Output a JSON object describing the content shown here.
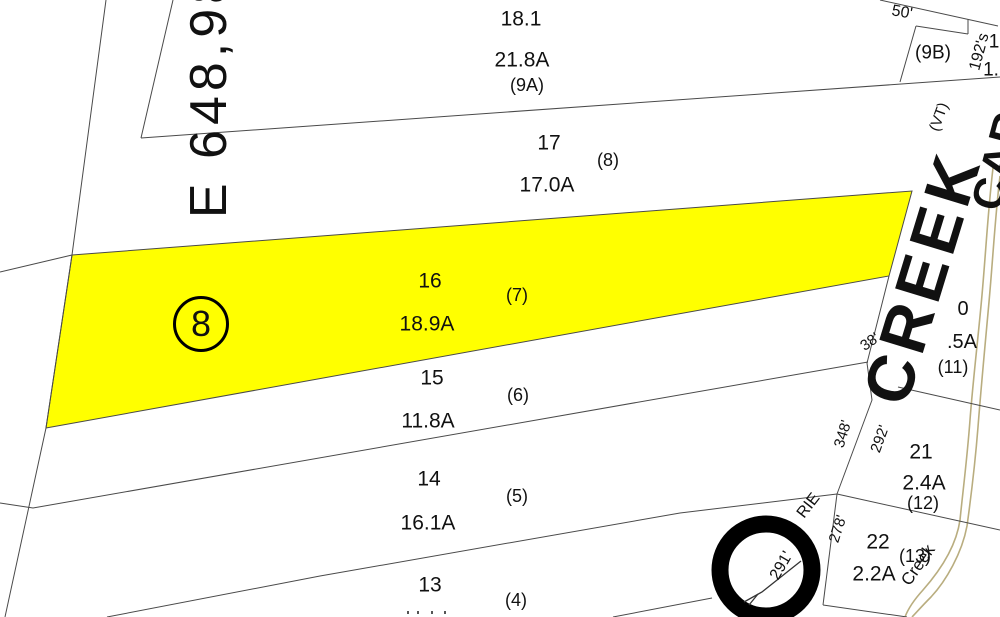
{
  "map_type": "tax-parcel-map",
  "colors": {
    "background": "#ffffff",
    "highlight": "#ffff00",
    "boundary_line": "#4a4a4a",
    "creek_line": "#b9ad7f",
    "ink": "#111111"
  },
  "circled_parcel": "8",
  "parcels": [
    {
      "number": "18.1",
      "area": "21.8A",
      "lot": "(9A)"
    },
    {
      "number": "17",
      "area": "17.0A",
      "lot": "(8)"
    },
    {
      "number": "16",
      "area": "18.9A",
      "lot": "(7)",
      "highlighted": true
    },
    {
      "number": "15",
      "area": "11.8A",
      "lot": "(6)"
    },
    {
      "number": "14",
      "area": "16.1A",
      "lot": "(5)"
    },
    {
      "number": "13",
      "area": "",
      "lot": "(4)"
    },
    {
      "number": "21",
      "area": "2.4A",
      "lot": "(12)"
    },
    {
      "number": "22",
      "area": "2.2A",
      "lot": "(13)"
    },
    {
      "number": "0",
      "area": ".5A",
      "lot": "(11)"
    },
    {
      "number": "",
      "area": "",
      "lot": "(9B)"
    }
  ],
  "labels": [
    {
      "n": "parcel-18-1-number",
      "t": "18.1",
      "x": 521,
      "y": 19,
      "s": 21
    },
    {
      "n": "parcel-18-1-area",
      "t": "21.8A",
      "x": 522,
      "y": 60,
      "s": 21
    },
    {
      "n": "parcel-18-1-lot",
      "t": "(9A)",
      "x": 527,
      "y": 85,
      "s": 18
    },
    {
      "n": "parcel-17-number",
      "t": "17",
      "x": 549,
      "y": 143,
      "s": 21
    },
    {
      "n": "parcel-17-lot",
      "t": "(8)",
      "x": 608,
      "y": 160,
      "s": 18
    },
    {
      "n": "parcel-17-area",
      "t": "17.0A",
      "x": 547,
      "y": 185,
      "s": 21
    },
    {
      "n": "parcel-16-number",
      "t": "16",
      "x": 430,
      "y": 281,
      "s": 21
    },
    {
      "n": "parcel-16-lot",
      "t": "(7)",
      "x": 517,
      "y": 295,
      "s": 18
    },
    {
      "n": "parcel-16-area",
      "t": "18.9A",
      "x": 427,
      "y": 324,
      "s": 21
    },
    {
      "n": "parcel-15-number",
      "t": "15",
      "x": 432,
      "y": 378,
      "s": 21
    },
    {
      "n": "parcel-15-lot",
      "t": "(6)",
      "x": 518,
      "y": 395,
      "s": 18
    },
    {
      "n": "parcel-15-area",
      "t": "11.8A",
      "x": 428,
      "y": 421,
      "s": 21
    },
    {
      "n": "parcel-14-number",
      "t": "14",
      "x": 429,
      "y": 479,
      "s": 21
    },
    {
      "n": "parcel-14-lot",
      "t": "(5)",
      "x": 517,
      "y": 496,
      "s": 18
    },
    {
      "n": "parcel-14-area",
      "t": "16.1A",
      "x": 428,
      "y": 523,
      "s": 21
    },
    {
      "n": "parcel-13-number",
      "t": "13",
      "x": 430,
      "y": 585,
      "s": 21
    },
    {
      "n": "parcel-13-lot",
      "t": "(4)",
      "x": 516,
      "y": 600,
      "s": 18
    },
    {
      "n": "parcel-21-number",
      "t": "21",
      "x": 921,
      "y": 452,
      "s": 21
    },
    {
      "n": "parcel-21-area",
      "t": "2.4A",
      "x": 924,
      "y": 483,
      "s": 21
    },
    {
      "n": "parcel-21-lot",
      "t": "(12)",
      "x": 923,
      "y": 503,
      "s": 18
    },
    {
      "n": "parcel-22-number",
      "t": "22",
      "x": 878,
      "y": 542,
      "s": 21
    },
    {
      "n": "parcel-22-lot",
      "t": "(13)",
      "x": 915,
      "y": 556,
      "s": 18
    },
    {
      "n": "parcel-22-area",
      "t": "2.2A",
      "x": 874,
      "y": 574,
      "s": 21
    },
    {
      "n": "parcel-20-number",
      "t": "0",
      "x": 963,
      "y": 309,
      "s": 20
    },
    {
      "n": "parcel-20-area",
      "t": ".5A",
      "x": 962,
      "y": 342,
      "s": 20
    },
    {
      "n": "parcel-20-lot",
      "t": "(11)",
      "x": 953,
      "y": 367,
      "s": 18
    },
    {
      "n": "parcel-9b-lot",
      "t": "(9B)",
      "x": 933,
      "y": 53,
      "s": 19
    },
    {
      "n": "dim-50",
      "t": "50'",
      "x": 902,
      "y": 13,
      "r": 10,
      "s": 16
    },
    {
      "n": "dim-192s",
      "t": "192's",
      "x": 980,
      "y": 52,
      "r": -75,
      "s": 16
    },
    {
      "n": "clipped-label-1",
      "t": "1",
      "x": 994,
      "y": 42,
      "s": 19
    },
    {
      "n": "clipped-label-2",
      "t": "1.",
      "x": 991,
      "y": 70,
      "s": 19
    },
    {
      "n": "state-label",
      "t": "(VT)",
      "x": 939,
      "y": 117,
      "r": -70,
      "s": 15
    },
    {
      "n": "dim-38",
      "t": "38'",
      "x": 870,
      "y": 342,
      "r": -35,
      "s": 15
    },
    {
      "n": "dim-348",
      "t": "348'",
      "x": 843,
      "y": 434,
      "r": -73,
      "s": 15
    },
    {
      "n": "dim-292",
      "t": "292'",
      "x": 880,
      "y": 439,
      "r": -70,
      "s": 15
    },
    {
      "n": "dim-278",
      "t": "278'",
      "x": 838,
      "y": 529,
      "r": -72,
      "s": 15
    },
    {
      "n": "road-name-fragment",
      "t": "RIE",
      "x": 809,
      "y": 506,
      "r": -52,
      "s": 16
    },
    {
      "n": "dim-291",
      "t": "291'",
      "x": 782,
      "y": 566,
      "r": -60,
      "s": 16
    },
    {
      "n": "creek-small-label",
      "t": "Creek",
      "x": 918,
      "y": 565,
      "r": -55,
      "s": 17
    },
    {
      "n": "grid-easting-label",
      "t": "E 648,98",
      "x": 209,
      "y": 94,
      "r": -90,
      "s": 52,
      "ls": 5
    },
    {
      "n": "creek-name-label",
      "t": "CREEK",
      "x": 922,
      "y": 277,
      "r": -73,
      "s": 66,
      "b": 1,
      "ls": 6
    },
    {
      "n": "adjacent-area-label",
      "t": "CARO",
      "x": 1004,
      "y": 143,
      "r": -75,
      "s": 44,
      "b": 1,
      "ls": 2
    }
  ]
}
